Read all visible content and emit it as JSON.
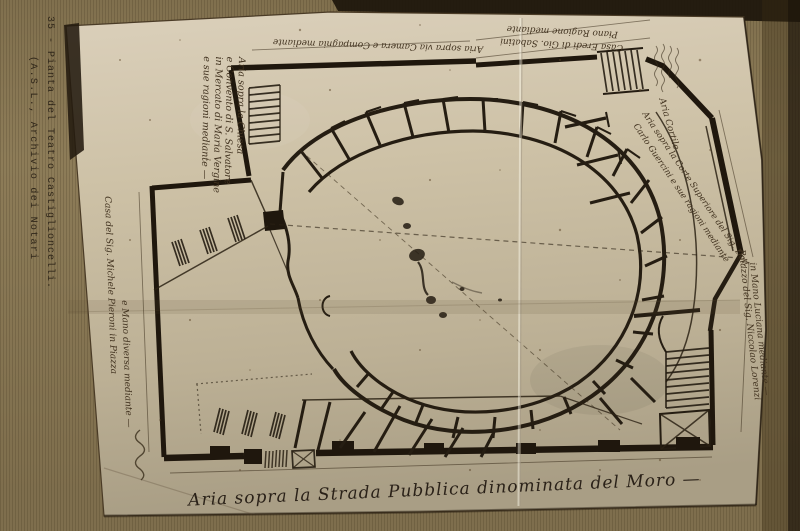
{
  "colors": {
    "mat_paper": "#8d7c58",
    "print_paper": "#cfc3a8",
    "ink": "#251d12",
    "caption_ink": "#30271a",
    "script_ink": "#41321f"
  },
  "caption": {
    "line1": "35 - Pianta del Teatro Castiglioncelli.",
    "line2": "(A.S.L., Archivio dei Notari"
  },
  "plan": {
    "street_label": "Aria sopra la Strada Pubblica dinominata del Moro —",
    "annotations": {
      "church_block": {
        "line1": "Aria sopra la Chiesa",
        "line2": "e Convento di S. Salvatore",
        "line3": "in Mercato di Maria Vergine",
        "line4": "e sue ragioni mediante —"
      },
      "top_edge_left": "Aria sopra via Camera e Compagnia mediante",
      "top_edge_right_line1": "Casa Eredi di Gio. Sabatini",
      "top_edge_right_line2": "Piano Ragione mediante",
      "courtyard": "Aria Cortile",
      "ne_wall_line1": "Aria sopra la Corte Superiore del Sig. Dott.",
      "ne_wall_line2": "Carlo Guercini e sue ragioni mediante",
      "right_edge_line1": "Palazzo del Sig. Niccolao Lorenzi",
      "right_edge_line2": "in Mano Luciana mediante —",
      "left_edge_line1": "Casa del Sig. Michele Pieroni in Piazza",
      "left_edge_line2": "e Mano diversa mediante —"
    }
  }
}
